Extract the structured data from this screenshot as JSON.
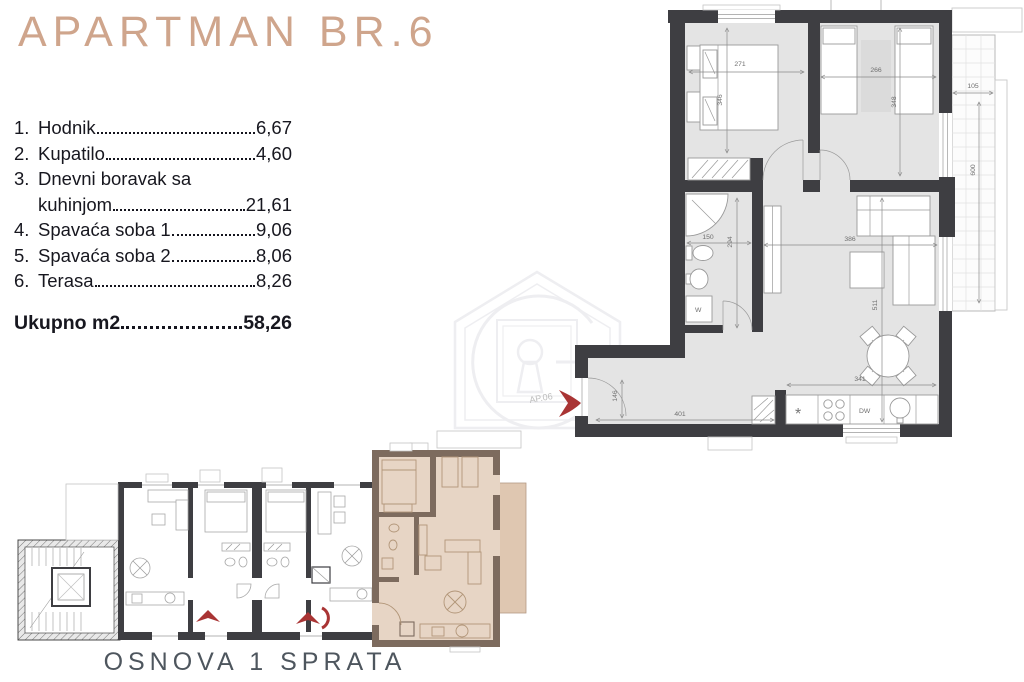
{
  "title": "APARTMAN BR.6",
  "room_list": {
    "rows": [
      {
        "num": "1.",
        "label": "Hodnik",
        "value": "6,67"
      },
      {
        "num": "2.",
        "label": "Kupatilo",
        "value": "4,60"
      },
      {
        "num": "3.",
        "label": "Dnevni boravak sa",
        "value": ""
      },
      {
        "num": "",
        "label": "kuhinjom",
        "value": "21,61"
      },
      {
        "num": "4.",
        "label": "Spavaća soba 1",
        "value": "9,06"
      },
      {
        "num": "5.",
        "label": "Spavaća soba 2",
        "value": "8,06"
      },
      {
        "num": "6.",
        "label": "Terasa",
        "value": "8,26"
      }
    ],
    "total": {
      "label": "Ukupno m2",
      "value": "58,26"
    }
  },
  "main_plan": {
    "unit_label": "AP.06",
    "dimensions": {
      "bedroom1_width": "271",
      "bedroom1_height": "346",
      "bedroom2_width": "266",
      "bedroom2_height": "348",
      "terrace_width": "105",
      "terrace_height": "600",
      "bathroom_width": "150",
      "bathroom_height": "294",
      "living_width": "386",
      "living_height": "511",
      "kitchen_width": "341",
      "hall_width": "401",
      "entry_height": "146"
    },
    "labels": {
      "washing_machine": "W",
      "dishwasher": "DW",
      "fridge": "*"
    }
  },
  "mini_plan": {
    "caption": "OSNOVA 1 SPRATA"
  },
  "colors": {
    "title_accent": "#cfa58c",
    "wall": "#3e3e42",
    "floor": "#e4e4e4",
    "highlight_floor": "#e7d5c5",
    "highlight_terrace": "#dfc7b1",
    "highlight_wall": "#7d6b5e",
    "entry_arrow": "#a93434"
  }
}
